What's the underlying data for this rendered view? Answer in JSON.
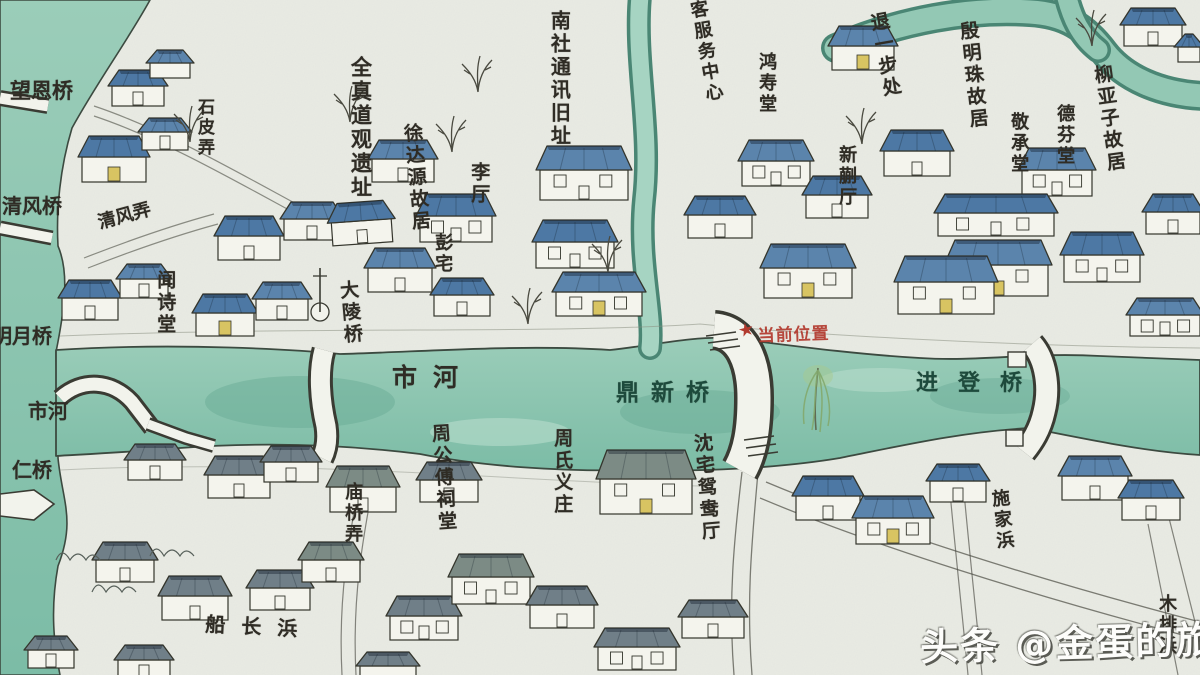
{
  "colors": {
    "paper": "#e9ebe4",
    "ink": "#34352c",
    "wall": "#f4f4ed",
    "water": "#8fc6b2",
    "waterDeep": "#6fb29d",
    "waterEdge": "#4a8674",
    "door": "#d8c462",
    "riverText": "#1d4a3c",
    "red": "#b23a2e",
    "roofs": {
      "b": "#4d78a4",
      "B": "#5b84ac",
      "g": "#707f88",
      "t": "#7c8b85"
    }
  },
  "marker": {
    "text": "当前位置",
    "star": "★",
    "color": "#b23a2e"
  },
  "watermark": {
    "text": "头条 @金蛋的旅程"
  },
  "labels": [
    {
      "text": "望恩桥",
      "x": 10,
      "y": 80,
      "dir": "h",
      "size": 21
    },
    {
      "text": "石皮弄",
      "x": 194,
      "y": 98,
      "dir": "v",
      "size": 17
    },
    {
      "text": "清风桥",
      "x": 2,
      "y": 195,
      "dir": "h",
      "size": 20
    },
    {
      "text": "清风弄",
      "x": 96,
      "y": 214,
      "dir": "h",
      "size": 18,
      "rot": -15
    },
    {
      "text": "闻诗堂",
      "x": 154,
      "y": 270,
      "dir": "v",
      "size": 19
    },
    {
      "text": "明月桥",
      "x": -8,
      "y": 325,
      "dir": "h",
      "size": 20
    },
    {
      "text": "市河",
      "x": 28,
      "y": 400,
      "dir": "h",
      "size": 20
    },
    {
      "text": "仁桥",
      "x": 12,
      "y": 459,
      "dir": "h",
      "size": 20
    },
    {
      "text": "全真道观遗址",
      "x": 348,
      "y": 56,
      "dir": "v",
      "size": 21
    },
    {
      "text": "徐达源故居",
      "x": 400,
      "y": 124,
      "dir": "v",
      "size": 19,
      "rot": -5
    },
    {
      "text": "李厅",
      "x": 468,
      "y": 162,
      "dir": "v",
      "size": 19
    },
    {
      "text": "彭宅",
      "x": 432,
      "y": 233,
      "dir": "v",
      "size": 18
    },
    {
      "text": "大陵桥",
      "x": 336,
      "y": 281,
      "dir": "v",
      "size": 19,
      "rot": -5
    },
    {
      "text": "南社通讯旧址",
      "x": 548,
      "y": 10,
      "dir": "v",
      "size": 20
    },
    {
      "text": "客服务中心",
      "x": 686,
      "y": 2,
      "dir": "v",
      "size": 18,
      "rot": -10
    },
    {
      "text": "鸿寿堂",
      "x": 756,
      "y": 52,
      "dir": "v",
      "size": 18
    },
    {
      "text": "退一步处",
      "x": 866,
      "y": 14,
      "dir": "v",
      "size": 19,
      "rot": -10
    },
    {
      "text": "新蒯厅",
      "x": 836,
      "y": 145,
      "dir": "v",
      "size": 18
    },
    {
      "text": "殷明珠故居",
      "x": 956,
      "y": 22,
      "dir": "v",
      "size": 19,
      "rot": -6
    },
    {
      "text": "敬承堂",
      "x": 1008,
      "y": 112,
      "dir": "v",
      "size": 18
    },
    {
      "text": "德芬堂",
      "x": 1054,
      "y": 104,
      "dir": "v",
      "size": 18
    },
    {
      "text": "柳亚子故居",
      "x": 1090,
      "y": 66,
      "dir": "v",
      "size": 19,
      "rot": -8
    },
    {
      "text": "市河",
      "x": 392,
      "y": 364,
      "dir": "h",
      "size": 25,
      "ls": 16
    },
    {
      "text": "鼎新桥",
      "x": 616,
      "y": 381,
      "dir": "h",
      "size": 23,
      "ls": 12,
      "color": "#1d4a3c"
    },
    {
      "text": "进登桥",
      "x": 916,
      "y": 372,
      "dir": "h",
      "size": 22,
      "ls": 20,
      "color": "#1d4a3c"
    },
    {
      "text": "庙桥弄",
      "x": 342,
      "y": 482,
      "dir": "v",
      "size": 18
    },
    {
      "text": "周公傅祠堂",
      "x": 428,
      "y": 424,
      "dir": "v",
      "size": 19,
      "rot": -4
    },
    {
      "text": "周氏义庄",
      "x": 551,
      "y": 428,
      "dir": "v",
      "size": 19
    },
    {
      "text": "沈宅鸳鸯厅",
      "x": 690,
      "y": 434,
      "dir": "v",
      "size": 19,
      "rot": -5
    },
    {
      "text": "施家浜",
      "x": 988,
      "y": 490,
      "dir": "v",
      "size": 18,
      "rot": -6
    },
    {
      "text": "木排浜",
      "x": 1156,
      "y": 594,
      "dir": "v",
      "size": 18
    },
    {
      "text": "船长浜",
      "x": 206,
      "y": 613,
      "dir": "h",
      "size": 20,
      "ls": 16,
      "rot": 3
    }
  ],
  "buildings": [
    {
      "x": 112,
      "y": 70,
      "w": 52,
      "h": 36,
      "c": "b"
    },
    {
      "x": 150,
      "y": 50,
      "w": 40,
      "h": 28,
      "c": "B"
    },
    {
      "x": 82,
      "y": 136,
      "w": 64,
      "h": 46,
      "c": "b",
      "d": 1
    },
    {
      "x": 142,
      "y": 118,
      "w": 46,
      "h": 32,
      "c": "B"
    },
    {
      "x": 218,
      "y": 216,
      "w": 62,
      "h": 44,
      "c": "b"
    },
    {
      "x": 284,
      "y": 202,
      "w": 56,
      "h": 38,
      "c": "B"
    },
    {
      "x": 62,
      "y": 280,
      "w": 56,
      "h": 40,
      "c": "b"
    },
    {
      "x": 120,
      "y": 264,
      "w": 48,
      "h": 34,
      "c": "B"
    },
    {
      "x": 196,
      "y": 294,
      "w": 58,
      "h": 42,
      "c": "b",
      "d": 1
    },
    {
      "x": 256,
      "y": 282,
      "w": 52,
      "h": 38,
      "c": "B"
    },
    {
      "x": 330,
      "y": 204,
      "w": 60,
      "h": 42,
      "c": "b",
      "r": -4
    },
    {
      "x": 372,
      "y": 140,
      "w": 62,
      "h": 42,
      "c": "B"
    },
    {
      "x": 420,
      "y": 194,
      "w": 72,
      "h": 48,
      "c": "b"
    },
    {
      "x": 368,
      "y": 248,
      "w": 64,
      "h": 44,
      "c": "B"
    },
    {
      "x": 434,
      "y": 278,
      "w": 56,
      "h": 38,
      "c": "b"
    },
    {
      "x": 540,
      "y": 146,
      "w": 88,
      "h": 54,
      "c": "B"
    },
    {
      "x": 536,
      "y": 220,
      "w": 78,
      "h": 48,
      "c": "b"
    },
    {
      "x": 556,
      "y": 272,
      "w": 86,
      "h": 44,
      "c": "B",
      "d": 1
    },
    {
      "x": 688,
      "y": 196,
      "w": 64,
      "h": 42,
      "c": "b"
    },
    {
      "x": 742,
      "y": 140,
      "w": 68,
      "h": 46,
      "c": "B"
    },
    {
      "x": 806,
      "y": 176,
      "w": 62,
      "h": 42,
      "c": "b"
    },
    {
      "x": 764,
      "y": 244,
      "w": 88,
      "h": 54,
      "c": "B",
      "d": 1
    },
    {
      "x": 884,
      "y": 130,
      "w": 66,
      "h": 46,
      "c": "b"
    },
    {
      "x": 832,
      "y": 26,
      "w": 62,
      "h": 44,
      "c": "B",
      "d": 1
    },
    {
      "x": 1124,
      "y": 8,
      "w": 58,
      "h": 38,
      "c": "b"
    },
    {
      "x": 1178,
      "y": 34,
      "w": 22,
      "h": 28,
      "c": "b"
    },
    {
      "x": 1022,
      "y": 148,
      "w": 70,
      "h": 48,
      "c": "B"
    },
    {
      "x": 938,
      "y": 194,
      "w": 116,
      "h": 42,
      "c": "b"
    },
    {
      "x": 948,
      "y": 240,
      "w": 100,
      "h": 56,
      "c": "B",
      "d": 1
    },
    {
      "x": 1064,
      "y": 232,
      "w": 76,
      "h": 50,
      "c": "b"
    },
    {
      "x": 898,
      "y": 256,
      "w": 96,
      "h": 58,
      "c": "B",
      "d": 1
    },
    {
      "x": 1146,
      "y": 194,
      "w": 54,
      "h": 40,
      "c": "b"
    },
    {
      "x": 1130,
      "y": 298,
      "w": 70,
      "h": 38,
      "c": "B"
    },
    {
      "x": 128,
      "y": 444,
      "w": 54,
      "h": 36,
      "c": "g"
    },
    {
      "x": 208,
      "y": 456,
      "w": 62,
      "h": 42,
      "c": "g"
    },
    {
      "x": 264,
      "y": 446,
      "w": 54,
      "h": 36,
      "c": "g"
    },
    {
      "x": 330,
      "y": 466,
      "w": 66,
      "h": 46,
      "c": "t"
    },
    {
      "x": 420,
      "y": 462,
      "w": 58,
      "h": 40,
      "c": "g"
    },
    {
      "x": 96,
      "y": 542,
      "w": 58,
      "h": 40,
      "c": "g"
    },
    {
      "x": 162,
      "y": 576,
      "w": 66,
      "h": 44,
      "c": "g"
    },
    {
      "x": 250,
      "y": 570,
      "w": 60,
      "h": 40,
      "c": "g"
    },
    {
      "x": 302,
      "y": 542,
      "w": 58,
      "h": 40,
      "c": "t"
    },
    {
      "x": 390,
      "y": 596,
      "w": 68,
      "h": 44,
      "c": "g"
    },
    {
      "x": 452,
      "y": 554,
      "w": 78,
      "h": 50,
      "c": "t"
    },
    {
      "x": 530,
      "y": 586,
      "w": 64,
      "h": 42,
      "c": "g"
    },
    {
      "x": 600,
      "y": 450,
      "w": 92,
      "h": 64,
      "c": "t",
      "d": 1
    },
    {
      "x": 598,
      "y": 628,
      "w": 78,
      "h": 42,
      "c": "g"
    },
    {
      "x": 682,
      "y": 600,
      "w": 62,
      "h": 38,
      "c": "g"
    },
    {
      "x": 796,
      "y": 476,
      "w": 64,
      "h": 44,
      "c": "b"
    },
    {
      "x": 856,
      "y": 496,
      "w": 74,
      "h": 48,
      "c": "B",
      "d": 1
    },
    {
      "x": 930,
      "y": 464,
      "w": 56,
      "h": 38,
      "c": "b"
    },
    {
      "x": 1062,
      "y": 456,
      "w": 66,
      "h": 44,
      "c": "B"
    },
    {
      "x": 1122,
      "y": 480,
      "w": 58,
      "h": 40,
      "c": "b"
    },
    {
      "x": 28,
      "y": 636,
      "w": 46,
      "h": 32,
      "c": "g"
    },
    {
      "x": 118,
      "y": 645,
      "w": 52,
      "h": 34,
      "c": "g"
    },
    {
      "x": 360,
      "y": 652,
      "w": 56,
      "h": 30,
      "c": "g"
    }
  ],
  "trees": [
    {
      "x": 190,
      "y": 116,
      "t": "ink"
    },
    {
      "x": 452,
      "y": 126,
      "t": "ink"
    },
    {
      "x": 478,
      "y": 66,
      "t": "ink"
    },
    {
      "x": 350,
      "y": 96,
      "t": "ink"
    },
    {
      "x": 608,
      "y": 246,
      "t": "ink"
    },
    {
      "x": 528,
      "y": 298,
      "t": "ink"
    },
    {
      "x": 862,
      "y": 118,
      "t": "ink"
    },
    {
      "x": 1092,
      "y": 20,
      "t": "ink"
    },
    {
      "x": 818,
      "y": 366,
      "t": "willow"
    },
    {
      "x": 56,
      "y": 560,
      "t": "bush"
    },
    {
      "x": 92,
      "y": 592,
      "t": "bush"
    },
    {
      "x": 150,
      "y": 556,
      "t": "bush"
    }
  ]
}
